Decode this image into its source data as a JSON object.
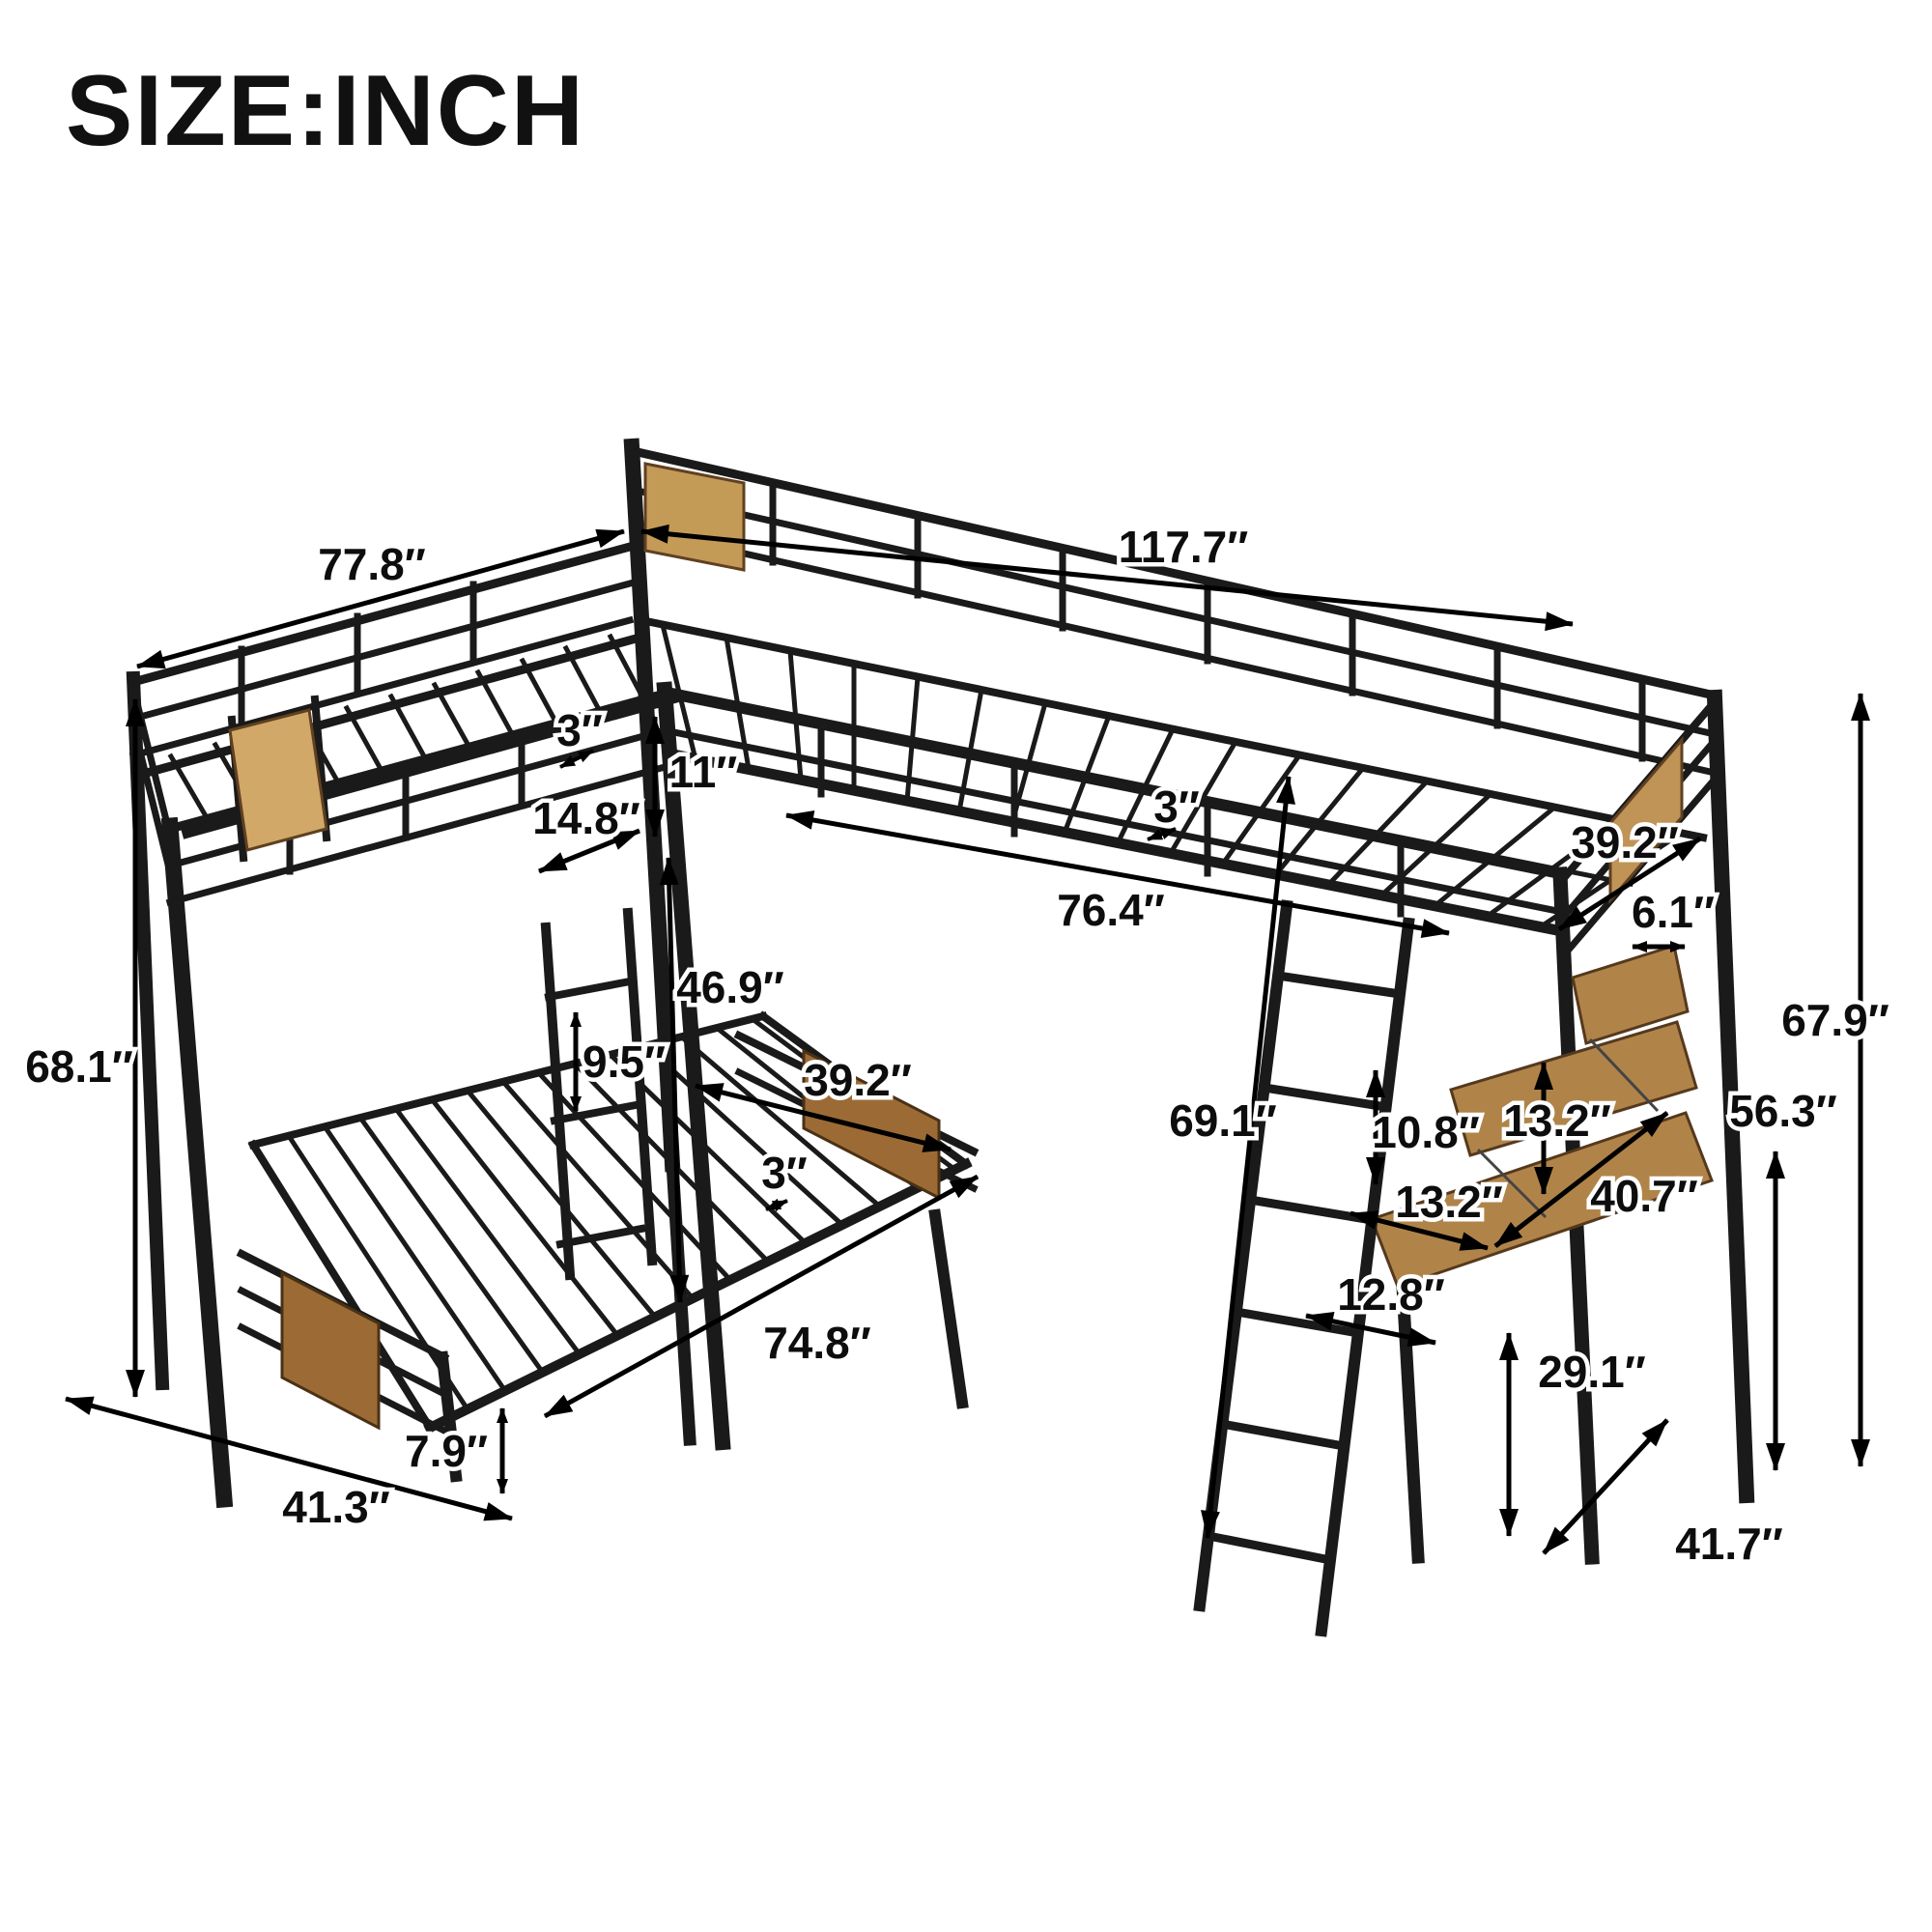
{
  "title": "SIZE:INCH",
  "unit": "inch",
  "colors": {
    "frame": "#1a1a1a",
    "dimension": "#000000",
    "label_halo": "#ffffff",
    "background": "#ffffff",
    "wood_light": "#d2a868",
    "wood_mid": "#b08449",
    "wood_dark": "#9c6b35",
    "wood_corner_panel": "#c49a57",
    "wood_right_panel": "#c09357"
  },
  "dims": {
    "d77_8": "77.8″",
    "d117_7": "117.7″",
    "d3_upper": "3″",
    "d11": "11″",
    "d14_8": "14.8″",
    "d3_loft": "3″",
    "d76_4": "76.4″",
    "d39_2_loft": "39.2″",
    "d6_1": "6.1″",
    "d68_1": "68.1″",
    "d46_9": "46.9″",
    "d9_5": "9.5″",
    "d39_2_lower": "39.2″",
    "d3_lower": "3″",
    "d74_8": "74.8″",
    "d69_1": "69.1″",
    "d10_8": "10.8″",
    "d13_2_shelf": "13.2″",
    "d13_2_desk": "13.2″",
    "d40_7": "40.7″",
    "d67_9": "67.9″",
    "d56_3": "56.3″",
    "d12_8": "12.8″",
    "d29_1": "29.1″",
    "d41_7": "41.7″",
    "d7_9": "7.9″",
    "d41_3": "41.3″"
  }
}
